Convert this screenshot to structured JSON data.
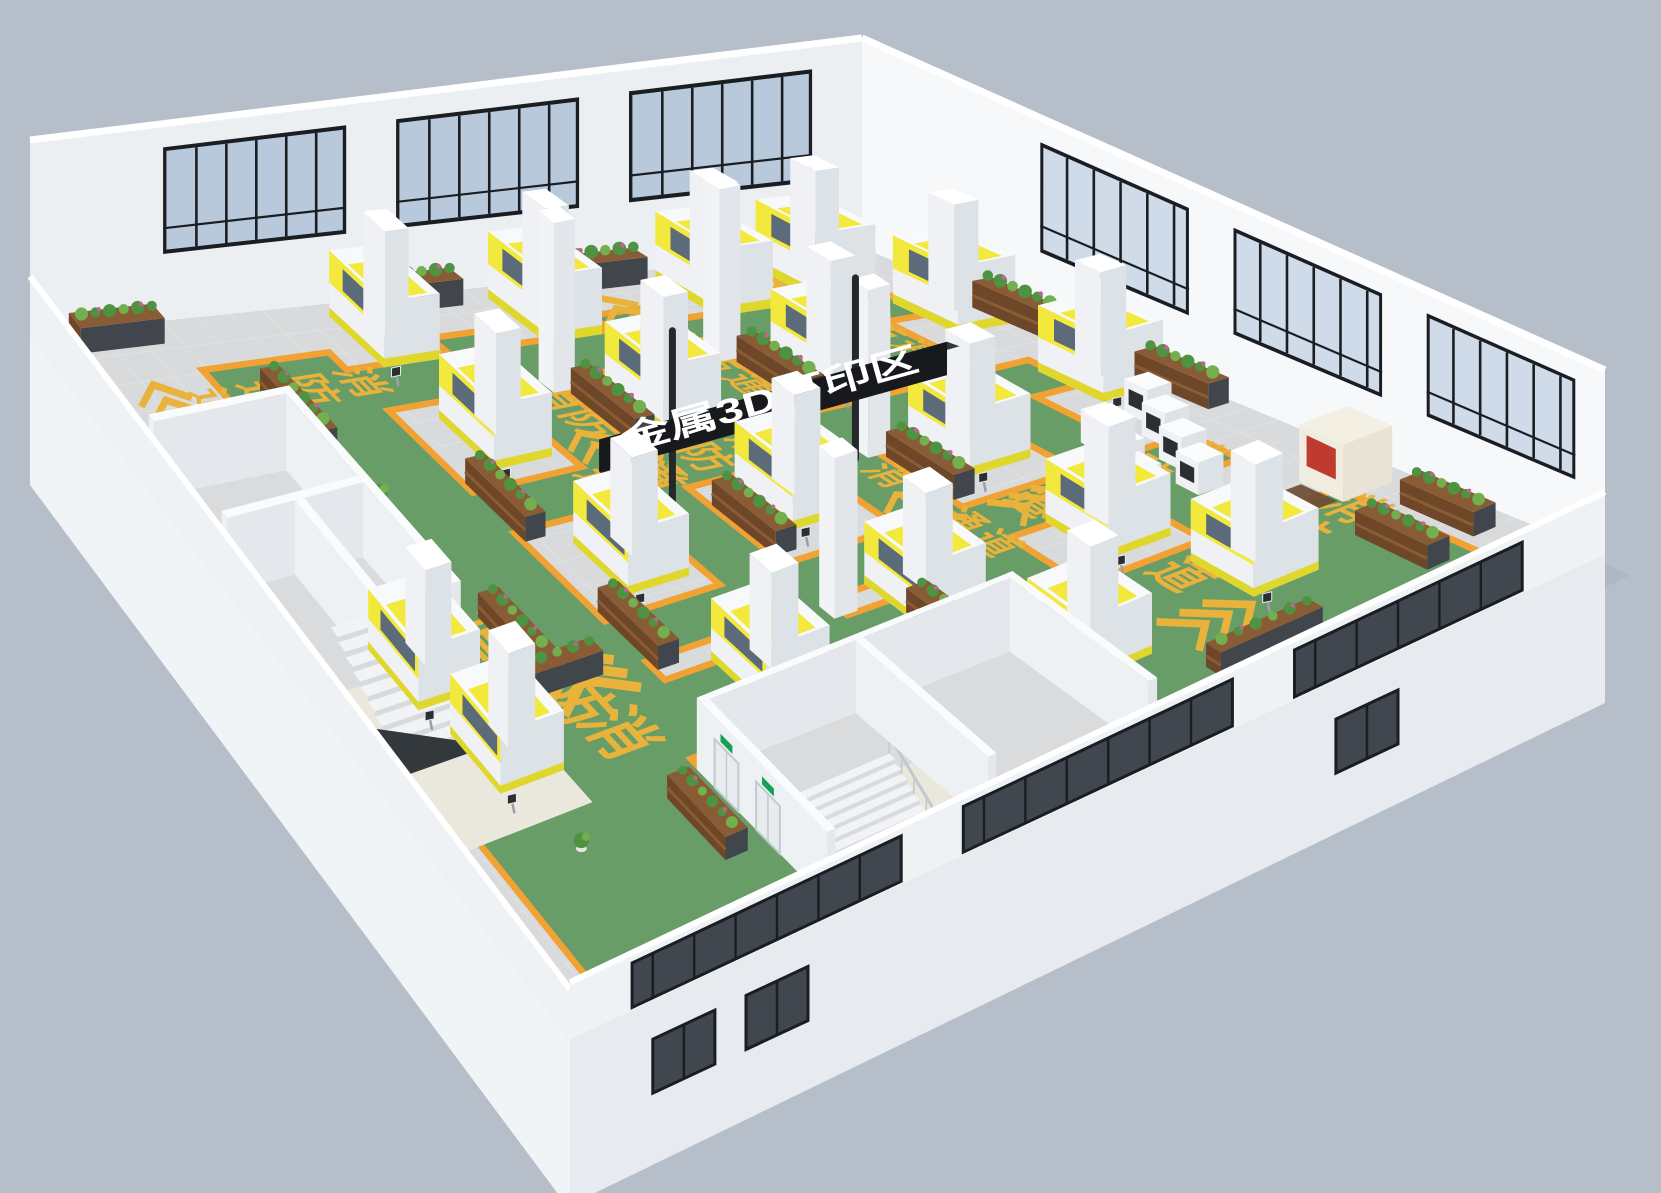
{
  "meta": {
    "title": "金属3D打印区 factory floor 3D render"
  },
  "sign": {
    "text": "金属3D打印区",
    "panel_color": "#17191c",
    "top_color": "#32363c",
    "pole_color": "#24272b",
    "text_color": "#ffffff"
  },
  "floor_text": {
    "label": "消防通道",
    "chars": [
      "消",
      "防",
      "通",
      "道"
    ],
    "color": "#e9b33b"
  },
  "colors": {
    "bg": "#b6bfc9",
    "shadow": "#a3adba",
    "floor": "#d8dadb",
    "tile": "#e3e5e6",
    "green": "#689d68",
    "orange": "#f2a233",
    "gold": "#e9b33b",
    "wall_nw": "#eceff2",
    "wall_ne": "#f6f8fa",
    "wall_top": "#ffffff",
    "wall_front": "#eff2f5",
    "wall_ext_r": "#e7ebef",
    "wall_ext_l": "#f1f4f7",
    "glass": "#b9c9dc",
    "glass_hi": "#cfdbe9",
    "frame": "#1a1e22",
    "glass_dark": "#40474e",
    "mach_top": "#f7f9fa",
    "mach_r": "#dde2e7",
    "mach_l": "#eff1f4",
    "yellow": "#f2e93c",
    "yellow_d": "#e0d72c",
    "mach_glass": "#5b6b7a",
    "panel": "#2b2f34",
    "panel_pole": "#9aa0a6",
    "rack_frame": "#41464c",
    "shelf": "#8a5c36",
    "shelf_d": "#6e4628",
    "plant": "#4d9341",
    "plant2": "#72b04f",
    "flower": "#c95f96",
    "pot": "#e8e6e1",
    "door": "#e9ecef",
    "door_frame": "#c3c9cf",
    "exit_green": "#15a254",
    "terrazzo": "#eae8dc",
    "pit": "#33383d",
    "rail": "#c3c8cd",
    "step_top": "#f2f3f4",
    "step_face": "#d7dbdf",
    "room_floor": "#d9dbdd",
    "cnc": "#e9e3d5",
    "cnc_red": "#c03b2f",
    "mat": "#6d4c35"
  },
  "scene": {
    "projection": {
      "N": [
        862,
        248
      ],
      "E": [
        1605,
        555
      ],
      "W": [
        30,
        335
      ],
      "S": [
        570,
        1040
      ]
    },
    "wall_height": {
      "N": 210,
      "E": 185,
      "W": 195,
      "S": 170
    },
    "ext_drop": {
      "left": [
        150,
        170
      ],
      "right": [
        148,
        165
      ]
    },
    "aisles": [
      [
        8,
        13,
        72,
        19
      ],
      [
        8,
        32,
        72,
        38
      ],
      [
        8,
        51,
        72,
        57
      ],
      [
        11,
        8,
        17,
        70
      ],
      [
        32,
        8,
        38,
        70
      ],
      [
        54,
        8,
        60,
        70
      ],
      [
        8,
        70,
        74,
        84
      ],
      [
        46,
        84,
        74,
        92
      ],
      [
        72,
        6,
        97,
        40
      ],
      [
        64,
        40,
        74,
        96
      ],
      [
        74,
        74,
        96,
        95
      ]
    ],
    "windows_nw": [
      [
        6,
        28
      ],
      [
        34,
        56
      ],
      [
        62,
        84
      ]
    ],
    "windows_ne": [
      [
        24,
        44
      ],
      [
        50,
        70
      ],
      [
        76,
        96
      ]
    ],
    "front_glass": [
      [
        8,
        30
      ],
      [
        36,
        62
      ],
      [
        68,
        94
      ]
    ],
    "ext_windows": [
      [
        20,
        26
      ],
      [
        77,
        83
      ],
      [
        86,
        92
      ]
    ],
    "machines": [
      [
        2,
        8
      ],
      [
        14,
        2
      ],
      [
        34,
        2
      ],
      [
        2,
        20
      ],
      [
        20,
        21
      ],
      [
        40,
        21
      ],
      [
        60,
        21
      ],
      [
        2,
        40
      ],
      [
        20,
        40
      ],
      [
        40,
        40
      ],
      [
        60,
        40
      ],
      [
        2,
        59
      ],
      [
        20,
        59
      ],
      [
        42,
        59
      ],
      [
        63,
        58
      ],
      [
        74,
        16
      ],
      [
        76,
        34
      ],
      [
        48,
        85
      ],
      [
        61,
        84
      ]
    ],
    "small_machines": [
      [
        46,
        6
      ],
      [
        51,
        8
      ],
      [
        56,
        10
      ],
      [
        61,
        12
      ],
      [
        49,
        13
      ],
      [
        54,
        15
      ],
      [
        59,
        17
      ]
    ],
    "cnc": [
      68,
      2
    ],
    "racks": [
      [
        18,
        0.5,
        "u"
      ],
      [
        40,
        0.5,
        "u"
      ],
      [
        78,
        2,
        "u"
      ],
      [
        0.5,
        28,
        "v"
      ],
      [
        0.5,
        50,
        "v"
      ],
      [
        20,
        29.2,
        "u"
      ],
      [
        42,
        29.2,
        "u"
      ],
      [
        20,
        48.2,
        "u"
      ],
      [
        42,
        48.2,
        "u"
      ],
      [
        30,
        67.2,
        "u"
      ],
      [
        52,
        67.2,
        "u"
      ],
      [
        66,
        44,
        "u"
      ],
      [
        48,
        77.5,
        "u"
      ],
      [
        58,
        74,
        "v"
      ],
      [
        12,
        78.5,
        "u"
      ],
      [
        1,
        86,
        "v"
      ],
      [
        80,
        8,
        "u"
      ],
      [
        90,
        22,
        "v"
      ],
      [
        78,
        76,
        "u"
      ]
    ],
    "pots": [
      [
        68,
        46
      ],
      [
        70,
        58
      ],
      [
        95,
        40
      ],
      [
        80,
        88
      ],
      [
        30,
        79
      ],
      [
        44,
        86
      ]
    ],
    "columns": [
      [
        17,
        30.5
      ],
      [
        39,
        30.5
      ],
      [
        17,
        49.5
      ],
      [
        61,
        49.5
      ]
    ],
    "texts": [
      {
        "start": [
          14,
          15.8
        ],
        "step": [
          5.2,
          0
        ],
        "size": 0.9
      },
      {
        "start": [
          14,
          34.8
        ],
        "step": [
          5.2,
          0
        ],
        "size": 0.9
      },
      {
        "start": [
          45,
          34.8
        ],
        "step": [
          5.2,
          0
        ],
        "size": 0.9
      },
      {
        "start": [
          20,
          53.8
        ],
        "step": [
          5.2,
          0
        ],
        "size": 1.0
      },
      {
        "start": [
          34.6,
          42
        ],
        "step": [
          0,
          5.6
        ],
        "size": 1.0
      },
      {
        "start": [
          56.6,
          11
        ],
        "step": [
          0,
          5.6
        ],
        "size": 1.0
      },
      {
        "start": [
          75.5,
          9
        ],
        "step": [
          0,
          5.8
        ],
        "size": 1.1
      },
      {
        "start": [
          12.6,
          71
        ],
        "step": [
          0,
          5.6
        ],
        "size": 1.0
      },
      {
        "start": [
          68,
          79.5
        ],
        "step": [
          -5.8,
          0.9
        ],
        "size": 1.35
      }
    ],
    "chevrons": [
      {
        "pos": [
          9,
          16
        ],
        "dir": [
          -1,
          0
        ],
        "size": 1
      },
      {
        "pos": [
          31,
          16
        ],
        "dir": [
          -1,
          0
        ],
        "size": 1
      },
      {
        "pos": [
          9,
          35
        ],
        "dir": [
          -1,
          0
        ],
        "size": 1
      },
      {
        "pos": [
          53,
          35
        ],
        "dir": [
          -1,
          0
        ],
        "size": 1
      },
      {
        "pos": [
          31,
          54
        ],
        "dir": [
          -1,
          0
        ],
        "size": 1
      },
      {
        "pos": [
          13.2,
          91
        ],
        "dir": [
          -1,
          0
        ],
        "size": 1.1
      },
      {
        "pos": [
          60,
          76
        ],
        "dir": [
          -1,
          0
        ],
        "size": 1.5
      },
      {
        "pos": [
          74,
          64
        ],
        "dir": [
          -1,
          0
        ],
        "size": 1.4
      },
      {
        "pos": [
          84,
          28
        ],
        "dir": [
          0,
          -1
        ],
        "size": 1.2
      },
      {
        "pos": [
          56.6,
          27
        ],
        "dir": [
          0,
          -1
        ],
        "size": 1.0
      }
    ],
    "sign": {
      "x": 41,
      "y_front": 62,
      "y_back": 24,
      "z_bot": 0.3,
      "z_top": 0.47,
      "poles": [
        34,
        54
      ],
      "pole_top": 0.93
    },
    "room_sw": {
      "floor": [
        23,
        85,
        52,
        100
      ],
      "walls": [
        [
          22,
          84,
          52,
          85
        ],
        [
          22,
          85,
          23,
          100
        ],
        [
          35.5,
          85,
          36.5,
          100
        ],
        [
          36.5,
          91.5,
          52,
          92.5
        ]
      ],
      "terrazzo": [
        [
          50,
          84,
          75,
          100
        ]
      ],
      "stairs": {
        "x0": 50.5,
        "y0": 86.5,
        "y1": 97,
        "steps": 10,
        "sw": 1.35,
        "ztop": 0.3,
        "dz": 0.03
      },
      "pit": [
        [
          57,
          97
        ],
        [
          64,
          88
        ],
        [
          64,
          99.5
        ],
        [
          57,
          99.5
        ]
      ]
    },
    "room_e": {
      "floor": [
        76.8,
        42.8,
        98,
        73.2
      ],
      "walls": [
        [
          76,
          42,
          98,
          42.8
        ],
        [
          76,
          42.8,
          76.8,
          74
        ],
        [
          76.8,
          57.6,
          98,
          58.4
        ],
        [
          76.8,
          73.2,
          98,
          74
        ]
      ],
      "terrazzo": [
        [
          86,
          58.4,
          98,
          73.2
        ]
      ],
      "doors": [
        [
          79,
          83
        ],
        [
          86,
          90
        ]
      ],
      "stairs": {
        "x0": 88,
        "y0": 62,
        "y1": 71,
        "steps": 7,
        "sw": 1.0,
        "ztop": 0.2,
        "dz": 0.026
      },
      "pit": [
        [
          95,
          62
        ],
        [
          98,
          62
        ],
        [
          98,
          71
        ],
        [
          95,
          71
        ]
      ]
    }
  }
}
